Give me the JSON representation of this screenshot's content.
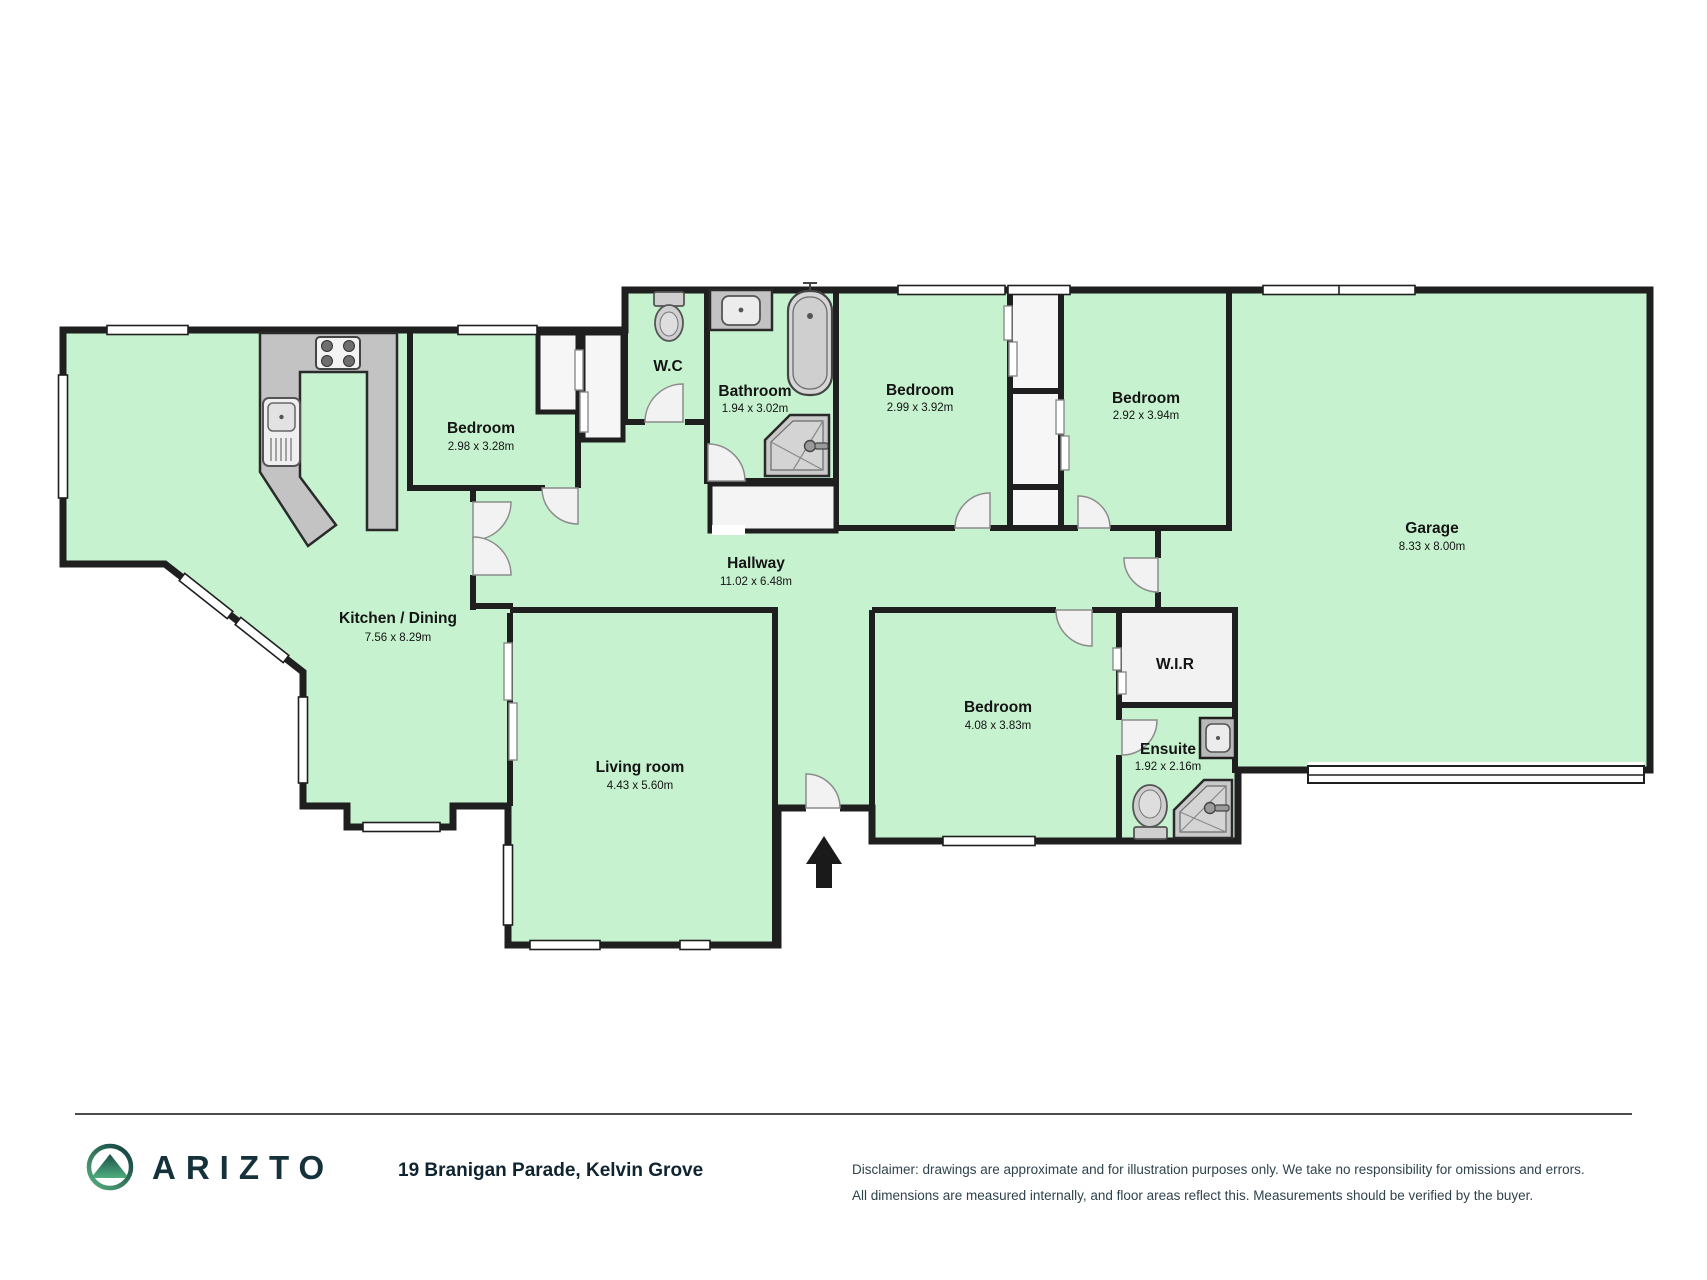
{
  "rooms": [
    {
      "name": "Kitchen / Dining",
      "dims": "7.56 x 8.29m"
    },
    {
      "name": "Bedroom",
      "dims": "2.98 x 3.28m"
    },
    {
      "name": "W.C",
      "dims": ""
    },
    {
      "name": "Bathroom",
      "dims": "1.94 x 3.02m"
    },
    {
      "name": "Bedroom",
      "dims": "2.99 x 3.92m"
    },
    {
      "name": "Bedroom",
      "dims": "2.92 x 3.94m"
    },
    {
      "name": "Garage",
      "dims": "8.33 x 8.00m"
    },
    {
      "name": "Hallway",
      "dims": "11.02 x 6.48m"
    },
    {
      "name": "Living room",
      "dims": "4.43 x 5.60m"
    },
    {
      "name": "Bedroom",
      "dims": "4.08 x 3.83m"
    },
    {
      "name": "W.I.R",
      "dims": ""
    },
    {
      "name": "Ensuite",
      "dims": "1.92 x 2.16m"
    }
  ],
  "footer": {
    "brand": "ARIZTO",
    "address": "19 Branigan Parade, Kelvin Grove",
    "disclaimer_line1": "Disclaimer: drawings are approximate and for illustration purposes only. We take no responsibility for omissions and errors.",
    "disclaimer_line2": "All dimensions are measured internally, and floor areas reflect this. Measurements should be verified by the buyer."
  },
  "colors": {
    "floor": "#c6f2cf",
    "wall": "#1f1f1f",
    "counter": "#c3c3c3",
    "fixture": "#cfcfcf",
    "brand_dark": "#15313c",
    "logo_teal": "#0f3b3e",
    "logo_green": "#57b07f"
  }
}
